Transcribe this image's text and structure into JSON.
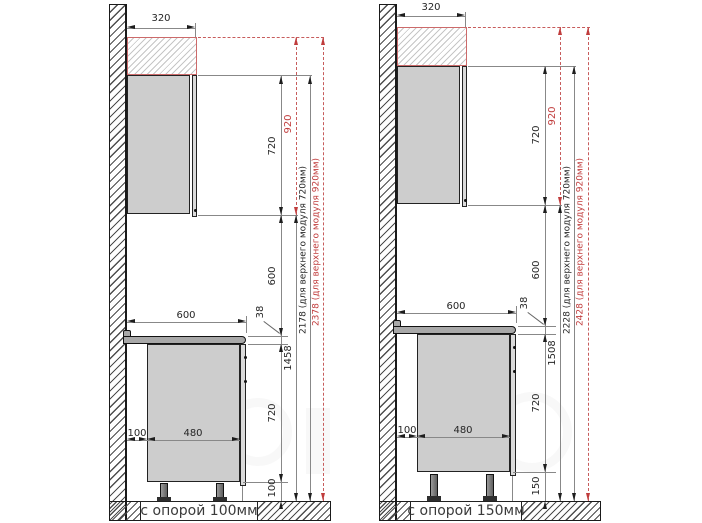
{
  "colors": {
    "accent_red": "#c03c3c",
    "cabinet_fill": "#cdcdcd",
    "countertop_fill": "#a8a8a8",
    "line": "#555555"
  },
  "diagrams": [
    {
      "support_label": "с опорой 100мм",
      "top_depth": "320",
      "upper_height": "720",
      "upper_height_alt": "920",
      "gap_height": "600",
      "counter_thickness": "38",
      "floor_to_upper": "1458",
      "total_height": "2178 (для верхнего модуля 720мм)",
      "total_height_alt": "2378 (для верхнего модуля 920мм)",
      "counter_depth": "600",
      "back_gap": "100",
      "base_depth": "480",
      "base_height": "720",
      "leg_height": "100"
    },
    {
      "support_label": "с опорой 150мм",
      "top_depth": "320",
      "upper_height": "720",
      "upper_height_alt": "920",
      "gap_height": "600",
      "counter_thickness": "38",
      "floor_to_upper": "1508",
      "total_height": "2228 (для верхнего модуля 720мм)",
      "total_height_alt": "2428 (для верхнего модуля 920мм)",
      "counter_depth": "600",
      "back_gap": "100",
      "base_depth": "480",
      "base_height": "720",
      "leg_height": "150"
    }
  ]
}
